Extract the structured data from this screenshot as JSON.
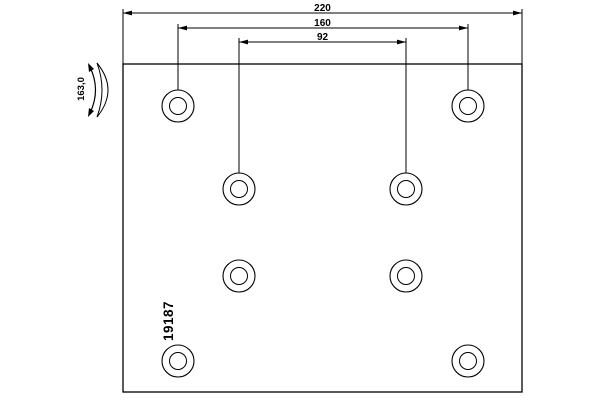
{
  "colors": {
    "line": "#000000",
    "background": "#ffffff"
  },
  "labels": {
    "total_width": "220",
    "outer_hole_spacing": "160",
    "inner_hole_spacing": "92",
    "radius": "163,0",
    "part_number": "19187"
  },
  "geometry": {
    "plate_px": {
      "x": 123,
      "y": 64,
      "width": 399,
      "height": 328
    },
    "holes_px": {
      "outer_radius": 16,
      "inner_radius": 8.5,
      "positions": [
        {
          "x": 178,
          "y": 106
        },
        {
          "x": 468,
          "y": 106
        },
        {
          "x": 239,
          "y": 189
        },
        {
          "x": 406,
          "y": 189
        },
        {
          "x": 239,
          "y": 276
        },
        {
          "x": 406,
          "y": 276
        },
        {
          "x": 178,
          "y": 361
        },
        {
          "x": 468,
          "y": 361
        }
      ]
    }
  }
}
